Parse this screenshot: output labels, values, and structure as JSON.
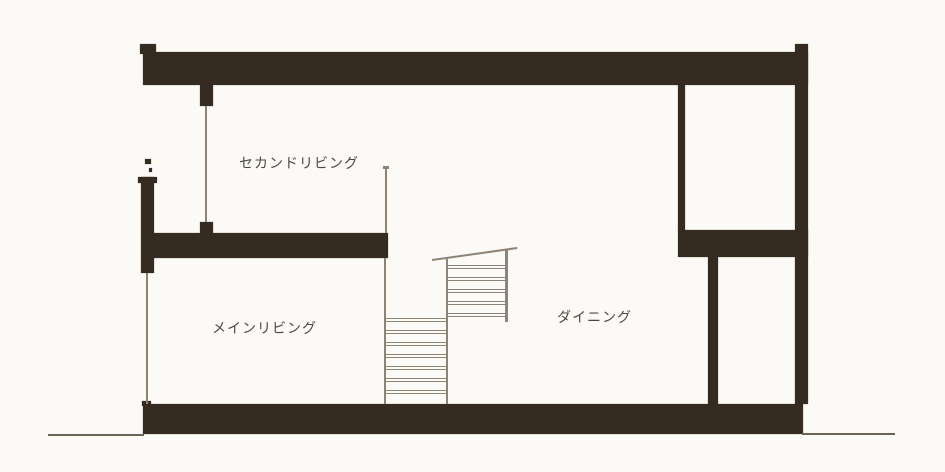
{
  "diagram_type": "architectural-cross-section",
  "rooms": [
    {
      "id": "second-living",
      "label": "セカンドリビング"
    },
    {
      "id": "main-living",
      "label": "メインリビング"
    },
    {
      "id": "dining",
      "label": "ダイニング"
    }
  ],
  "stairs": {
    "lower_flight_steps": 7,
    "upper_flight_steps": 5
  },
  "colors": {
    "background": "#fbfaf6",
    "wall": "#362b21",
    "line": "#8e8375",
    "line_dark": "#6e6357",
    "text": "#4e4840"
  }
}
